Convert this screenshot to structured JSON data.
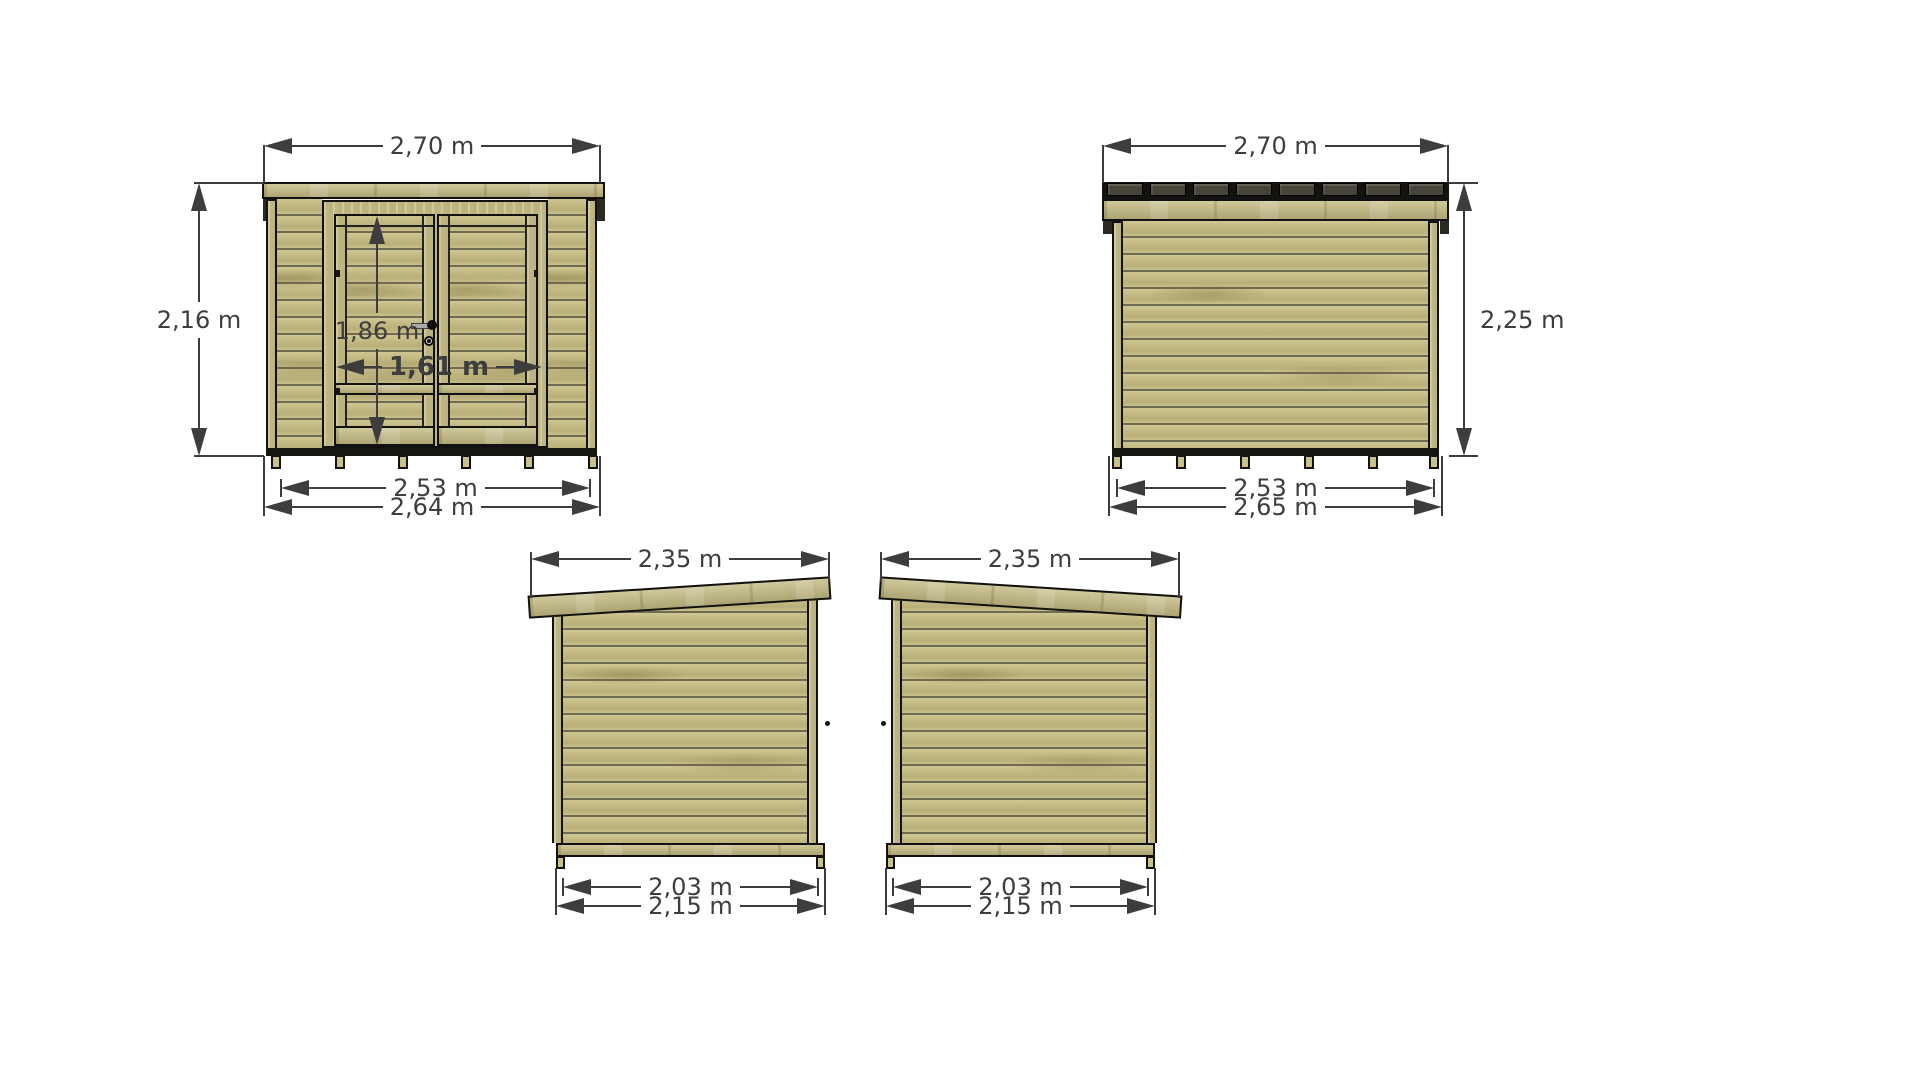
{
  "drawing_title": "garden shed elevation drawings",
  "views": {
    "front": {
      "width_top": "2,70 m",
      "height_left": "2,16 m",
      "door_height": "1,86 m",
      "door_width": "1,61 m",
      "width_inner": "2,53 m",
      "width_outer": "2,64 m"
    },
    "back": {
      "width_top": "2,70 m",
      "height_right": "2,25 m",
      "width_inner": "2,53 m",
      "width_outer": "2,65 m"
    },
    "side_left": {
      "width_top": "2,35 m",
      "width_inner": "2,03 m",
      "width_outer": "2,15 m"
    },
    "side_right": {
      "width_top": "2,35 m",
      "width_inner": "2,03 m",
      "width_outer": "2,15 m"
    }
  },
  "colors": {
    "background": "#ffffff",
    "dimension": "#3d3d3d",
    "outline": "#111111",
    "wood_base": "#c6bd87",
    "wood_seam": "#6f6a52",
    "roof_felt": "#14120e",
    "felt_block": "#474439"
  }
}
